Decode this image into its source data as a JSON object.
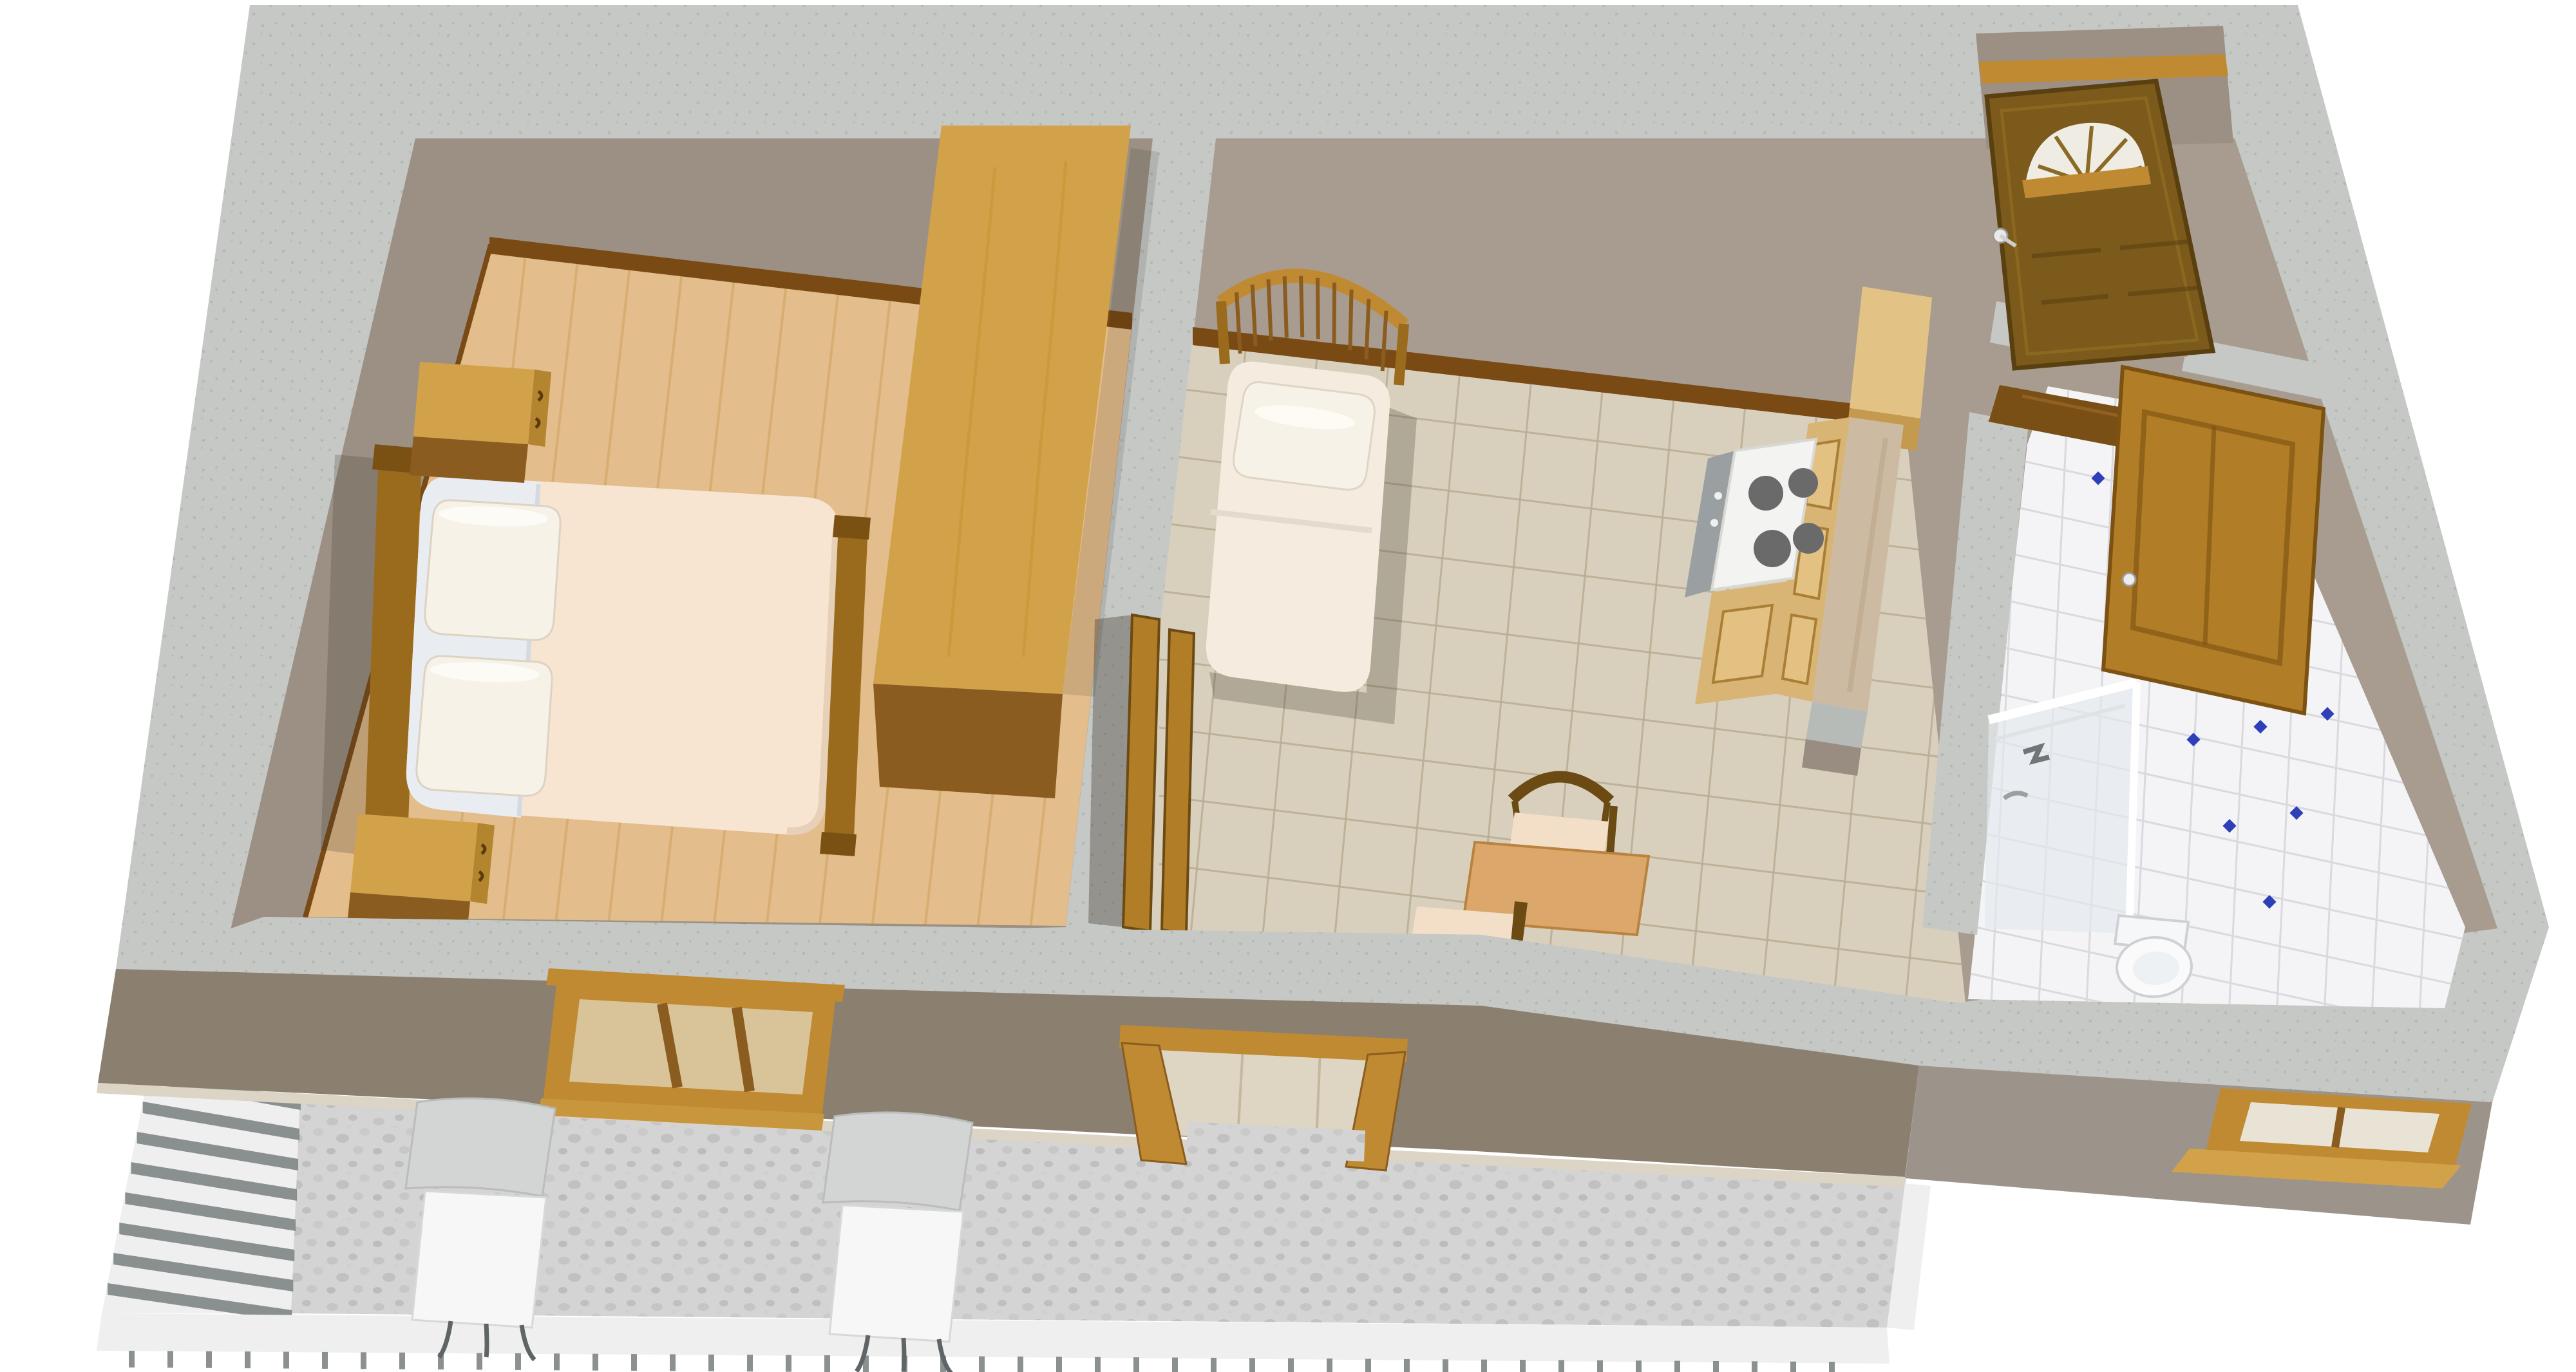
{
  "scene": {
    "type": "3d-floorplan-render",
    "view": "birds-eye perspective, cutaway walls",
    "building": "one-bedroom apartment with front terrace"
  },
  "rooms": [
    {
      "id": "bedroom",
      "name": "bedroom",
      "floor": "light wood parquet",
      "items": [
        "double-bed",
        "pillow",
        "pillow",
        "headboard",
        "footboard",
        "nightstand",
        "nightstand",
        "wardrobe",
        "front-window"
      ]
    },
    {
      "id": "living-kitchen",
      "name": "living room with kitchen",
      "floor": "beige ceramic tile",
      "items": [
        "single-bed-with-spindle-headboard",
        "pillow",
        "stove-4-burners",
        "kitchen-cabinets",
        "tall-cabinet",
        "marble-counter",
        "dining-table",
        "chair",
        "chair",
        "terrace-double-door-open"
      ]
    },
    {
      "id": "entry",
      "name": "entry",
      "floor": "dark wood",
      "items": [
        "front-door-open-with-fanlight",
        "door-handle"
      ]
    },
    {
      "id": "bathroom",
      "name": "bathroom",
      "floor": "white tile with blue diamond accents",
      "items": [
        "shower-enclosure",
        "toilet",
        "bathroom-door-open",
        "small-window"
      ]
    },
    {
      "id": "terrace",
      "name": "terrace",
      "floor": "gray stone",
      "items": [
        "lounge-chair",
        "lounge-chair",
        "white-railing"
      ]
    }
  ],
  "counts": {
    "stove_burners": 4,
    "bed_pillows": 2,
    "lounge_chairs": 2,
    "terrace_door_leaves": 2,
    "bedroom_window_panes": 3
  },
  "colors": {
    "background": "#ffffff",
    "wall_top": "#c5c8c4",
    "wall_speckle": "#a9afa9",
    "interior_wall": "#9b9083",
    "interior_wall_right": "#a79c8f",
    "exterior_front": "#8b7f70",
    "exterior_front_right": "#9c948a",
    "base_strip": "#dcd5c6",
    "baseboard": "#7a4a15",
    "wood_floor": "#e3bd8b",
    "wood_floor_line": "#d0a05e",
    "tile_floor": "#d8d0bd",
    "tile_grout": "#b9ac92",
    "bath_tile": "#f4f4f6",
    "bath_grout": "#d9d9de",
    "bath_accent": "#2e3fb8",
    "terrace_floor": "#d4d4d4",
    "railing": "#efefef",
    "railing_rung": "#7e8585",
    "door_wood": "#7b5a1b",
    "frame_wood": "#c08a33",
    "door_leaf_wood": "#b17d26",
    "furniture_wood": "#d2a24b",
    "furniture_wood_dark": "#8a5c1f",
    "bed_blanket": "#f7e5d1",
    "bed_sheet": "#e9edf2",
    "pillow": "#f7f2e8",
    "single_bed_linen": "#f5ecdf",
    "headboard_wood": "#9a6b1c",
    "stove": "#f3f3f1",
    "burner": "#6a6a6a",
    "cabinet": "#d9b575",
    "counter": "#cdbaa2",
    "table": "#dca76a",
    "chair_seat": "#f3dfc7",
    "chair_wood": "#6b4a14",
    "lounge_chair_seat": "#f7f7f7",
    "lounge_chair_back": "#d2d5d4",
    "shower_glass": "#e4e8ec",
    "fixture_white": "#fafafa"
  }
}
